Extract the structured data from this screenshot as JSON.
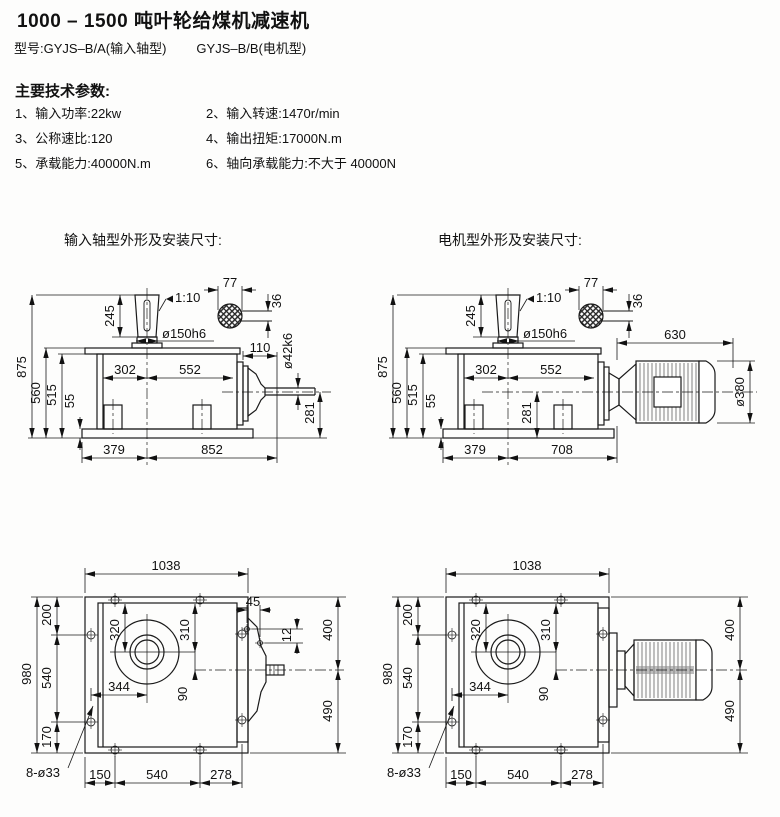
{
  "header": {
    "title": "1000 – 1500 吨叶轮给煤机减速机",
    "model_prefix": "型号:",
    "model_a": "GYJS–B/A(输入轴型)",
    "model_b": "GYJS–B/B(电机型)"
  },
  "specs": {
    "heading": "主要技术参数:",
    "items": [
      "1、输入功率:22kw",
      "2、输入转速:1470r/min",
      "3、公称速比:120",
      "4、输出扭矩:17000N.m",
      "5、承载能力:40000N.m",
      "6、轴向承载能力:不大于 40000N"
    ]
  },
  "sections": {
    "input_shaft_label": "输入轴型外形及安装尺寸:",
    "motor_label": "电机型外形及安装尺寸:"
  },
  "dims": {
    "side_input": {
      "shaft_len": "245",
      "taper": "1:10",
      "shaft_dia": "ø150h6",
      "key_w": "77",
      "key_h": "36",
      "total_h": "875",
      "cover_h": "560",
      "body_h": "515",
      "base_h": "55",
      "left_w": "302",
      "right_w": "552",
      "stub_len": "110",
      "out_dia": "ø42k6",
      "axis_h": "281",
      "base_left": "379",
      "base_right": "852"
    },
    "side_motor": {
      "shaft_len": "245",
      "taper": "1:10",
      "shaft_dia": "ø150h6",
      "key_w": "77",
      "key_h": "36",
      "total_h": "875",
      "cover_h": "560",
      "body_h": "515",
      "base_h": "55",
      "left_w": "302",
      "right_w": "552",
      "motor_len": "630",
      "motor_dia": "ø380",
      "axis_h": "281",
      "base_left": "379",
      "base_right": "708"
    },
    "plan_input": {
      "top_w": "1038",
      "total_d": "980",
      "front_d": "200",
      "mid_d": "540",
      "rear_d": "170",
      "bore_y_left": "320",
      "bore_y_right": "310",
      "bore_x": "344",
      "axis_offset": "90",
      "hole_dx": "45",
      "hole_dy": "12",
      "right_front": "400",
      "right_rear": "490",
      "holes": "8-ø33",
      "bot_left": "150",
      "bot_mid": "540",
      "bot_right": "278"
    },
    "plan_motor": {
      "top_w": "1038",
      "total_d": "980",
      "front_d": "200",
      "mid_d": "540",
      "rear_d": "170",
      "bore_y_left": "320",
      "bore_y_right": "310",
      "bore_x": "344",
      "axis_offset": "90",
      "right_front": "400",
      "right_rear": "490",
      "holes": "8-ø33",
      "bot_left": "150",
      "bot_mid": "540",
      "bot_right": "278"
    }
  }
}
